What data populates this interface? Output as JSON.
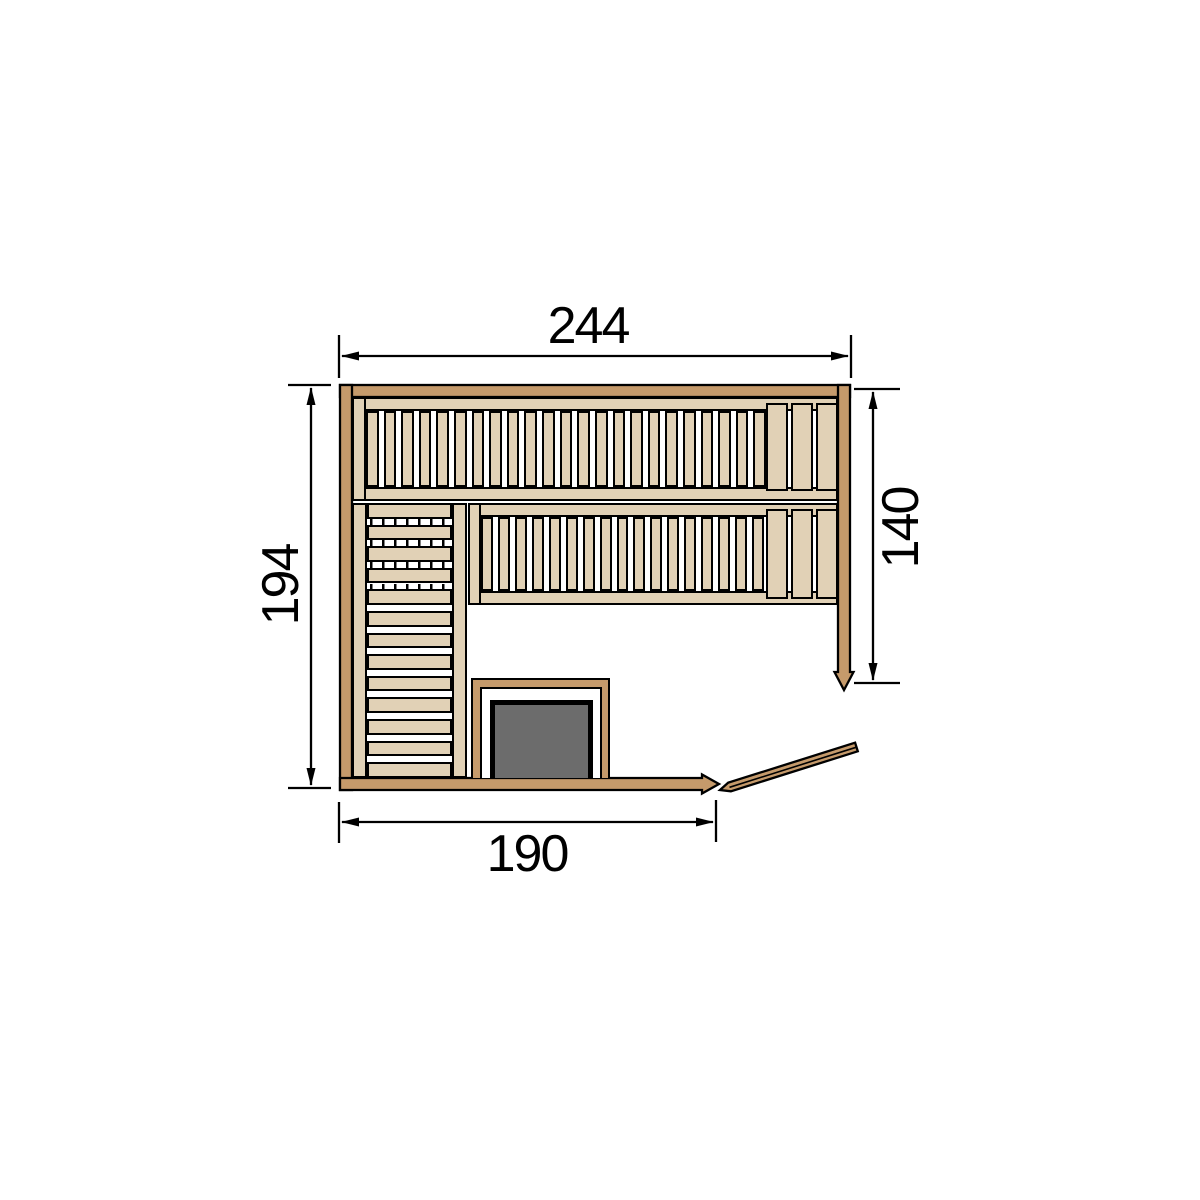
{
  "diagram": {
    "title": "sauna floor plan",
    "dimensions": {
      "width_top": "244",
      "height_left": "194",
      "height_right": "140",
      "width_bottom": "190"
    },
    "colors": {
      "wall": "#c59a6b",
      "wood": "#e1d1b6",
      "stove": "#6c6c6c",
      "line": "#000000",
      "background": "#ffffff"
    },
    "parts": {
      "upper_bench": {
        "slat_count": 23,
        "headrest_plank_count": 3
      },
      "lower_bench": {
        "slat_count": 17,
        "headrest_plank_count": 3
      },
      "left_bench": {
        "slat_count": 13,
        "dashed_gap_count": 4
      },
      "door": {
        "leaf_count": 1
      },
      "stove": {
        "count": 1
      }
    }
  }
}
